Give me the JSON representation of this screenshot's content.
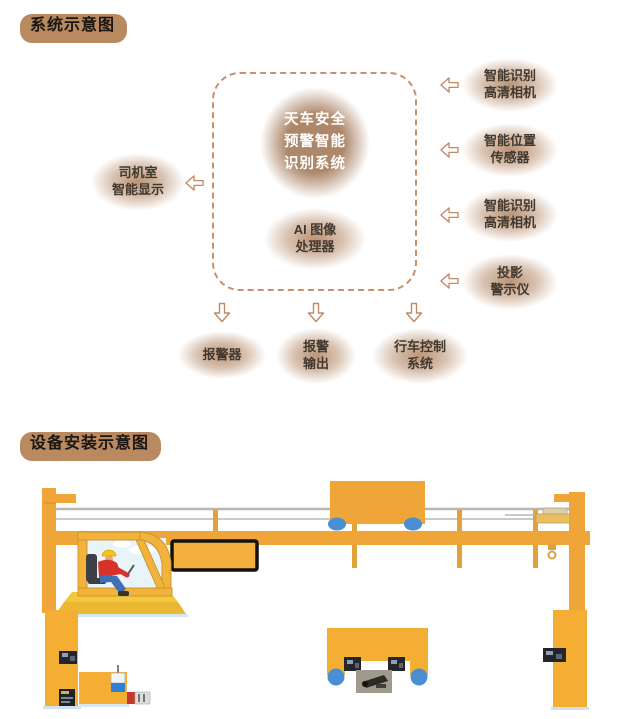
{
  "colors": {
    "accent_tan": "#b9895f",
    "box_halo_tan": "#b88f6f",
    "dashed_border": "#ca9069",
    "arrow_outline": "#c08a63",
    "circle_fill": "#ad876a",
    "circle_text": "#ffffff",
    "label_text": "#41392f",
    "crane_yellow": "#f2a93c",
    "crane_column_yellow": "#f4ae33",
    "wheel_blue": "#4a8fd3",
    "rail_gray": "#b7b7b2",
    "driver_shirt_red": "#d63229",
    "driver_pants_blue": "#3f6fb5",
    "helmet_yellow": "#f6c514"
  },
  "section1": {
    "title": "系统示意图",
    "center_circle": "天车安全\n预警智能\n识别系统",
    "ai_box": "AI 图像\n处理器",
    "left_box": "司机室\n智能显示",
    "right_boxes": {
      "0": "智能识别\n高清相机",
      "1": "智能位置\n传感器",
      "2": "智能识别\n高清相机",
      "3": "投影\n警示仪"
    },
    "bottom_boxes": {
      "0": "报警器",
      "1": "报警\n输出",
      "2": "行车控制\n系统"
    }
  },
  "section2": {
    "title": "设备安装示意图"
  }
}
